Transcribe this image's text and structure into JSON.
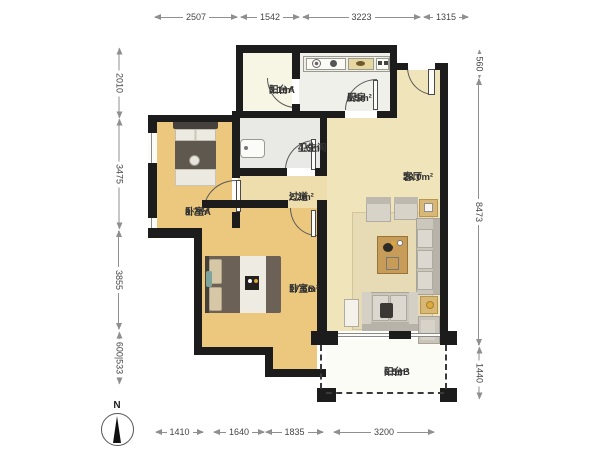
{
  "plan_title": "apartment-floor-plan",
  "compass": {
    "label": "N"
  },
  "rooms": [
    {
      "id": "balcony-a",
      "name": "阳台A",
      "area": "3.1m²"
    },
    {
      "id": "kitchen",
      "name": "厨房",
      "area": "6.5m²"
    },
    {
      "id": "bathroom",
      "name": "卫生间",
      "area": "4.6m²"
    },
    {
      "id": "hallway",
      "name": "过道",
      "area": "2.2m²"
    },
    {
      "id": "living-room",
      "name": "客厅",
      "area": "28.0m²"
    },
    {
      "id": "bedroom-a",
      "name": "卧室A",
      "area": "8.7m²"
    },
    {
      "id": "bedroom-b",
      "name": "卧室B",
      "area": "17.6m²"
    },
    {
      "id": "balcony-b",
      "name": "阳台B",
      "area": "6.5m²"
    }
  ],
  "dimensions": {
    "top": [
      "2507",
      "1542",
      "3223",
      "1315"
    ],
    "bottom": [
      "1410",
      "1640",
      "1835",
      "3200"
    ],
    "left": [
      "2010",
      "3475",
      "3855",
      "600|533"
    ],
    "right": [
      "560",
      "8473",
      "1440"
    ]
  },
  "colors": {
    "wall": "#1c1c1c",
    "bedroom_floor": "#ecc87f",
    "living_floor": "#f0e4ba",
    "kitchen_floor": "#eff0e9",
    "bathroom_floor": "#e9e9e5",
    "balcony_a_floor": "#f7f5e4",
    "balcony_b_floor": "#fcfcf7",
    "dimension_line": "#8f8f8f",
    "label_text": "#333333"
  }
}
